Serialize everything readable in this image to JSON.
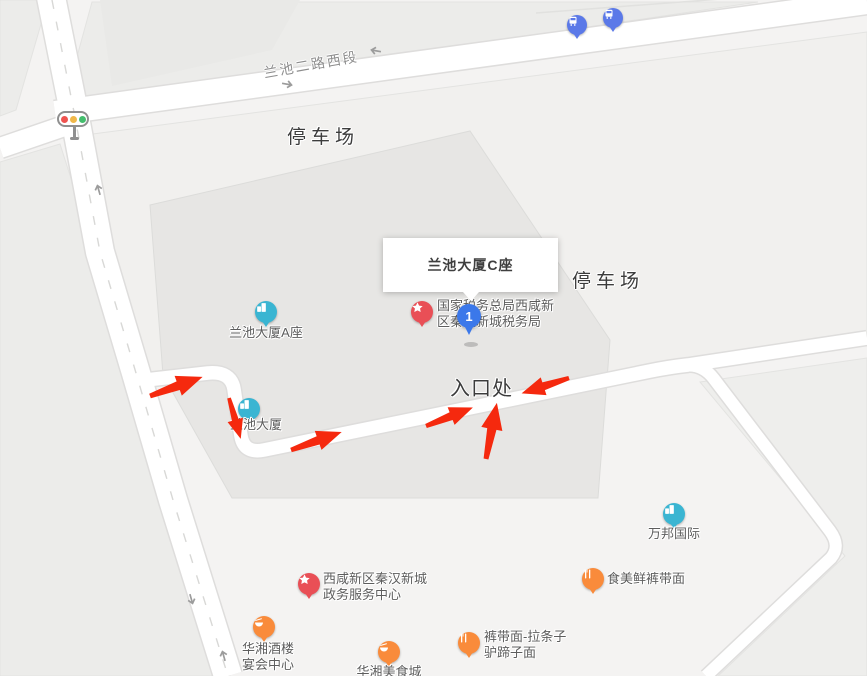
{
  "map": {
    "road_label": {
      "name": "road-label-lanchi-2nd-road",
      "text": "兰池二路西段",
      "x": 262,
      "y": 63,
      "angle": -10
    },
    "area_labels": [
      {
        "name": "parking-lot-label-top",
        "text": "停车场",
        "x": 287,
        "y": 122,
        "size": 19,
        "ls": 5
      },
      {
        "name": "parking-lot-label-right",
        "text": "停车场",
        "x": 572,
        "y": 266,
        "size": 19,
        "ls": 5
      },
      {
        "name": "entrance-label",
        "text": "入口处",
        "x": 450,
        "y": 372,
        "size": 20,
        "ls": 1
      }
    ],
    "infobox": {
      "title": "兰池大厦C座"
    },
    "selected_marker": {
      "label": "1"
    },
    "colors": {
      "poi_teal": "#3ab5d2",
      "poi_orange": "#f98b3b",
      "poi_red": "#e94f56",
      "bus_blue": "#5b79e8",
      "marker_blue": "#3b78ea",
      "route_arrow_red": "#f5290e",
      "road_white": "#ffffff",
      "building_gray": "#e7e6e4"
    },
    "pois": [
      {
        "name": "poi-lanchi-tower-a",
        "icon": "building-icon",
        "color": "#3ab5d2",
        "x": 266,
        "y": 312,
        "label": {
          "text": "兰池大厦A座",
          "x": 266,
          "y": 325,
          "align": "center"
        }
      },
      {
        "name": "poi-lanchi-tower",
        "icon": "building-icon",
        "color": "#3ab5d2",
        "x": 249,
        "y": 409,
        "label": {
          "text": "兰池大厦",
          "x": 256,
          "y": 417,
          "align": "center"
        }
      },
      {
        "name": "poi-wanbang-international",
        "icon": "building-icon",
        "color": "#3ab5d2",
        "x": 674,
        "y": 514,
        "label": {
          "text": "万邦国际",
          "x": 674,
          "y": 526,
          "align": "center"
        }
      },
      {
        "name": "poi-tax-bureau",
        "icon": "star-icon",
        "color": "#e94f56",
        "x": 422,
        "y": 312,
        "label": {
          "text": "国家税务总局西咸新\n区秦汉新城税务局",
          "x": 437,
          "y": 298,
          "align": "left"
        }
      },
      {
        "name": "poi-government-service-center",
        "icon": "star-icon",
        "color": "#e94f56",
        "x": 309,
        "y": 584,
        "label": {
          "text": "西咸新区秦汉新城\n政务服务中心",
          "x": 323,
          "y": 571,
          "align": "left"
        }
      },
      {
        "name": "poi-shimeixian-noodles",
        "icon": "restaurant-icon",
        "color": "#f98b3b",
        "x": 593,
        "y": 579,
        "label": {
          "text": "食美鲜裤带面",
          "x": 607,
          "y": 571,
          "align": "left"
        }
      },
      {
        "name": "poi-kudaimian-noodles",
        "icon": "restaurant-icon",
        "color": "#f98b3b",
        "x": 469,
        "y": 643,
        "label": {
          "text": "裤带面-拉条子\n驴蹄子面",
          "x": 484,
          "y": 629,
          "align": "left"
        }
      },
      {
        "name": "poi-huaxiang-banquet-hall",
        "icon": "dish-icon",
        "color": "#f98b3b",
        "x": 264,
        "y": 627,
        "label": {
          "text": "华湘酒楼\n宴会中心",
          "x": 268,
          "y": 641,
          "align": "center"
        }
      },
      {
        "name": "poi-huaxiang-food-city",
        "icon": "dish-icon",
        "color": "#f98b3b",
        "x": 389,
        "y": 652,
        "label": {
          "text": "华湘美食城",
          "x": 389,
          "y": 664,
          "align": "center"
        }
      }
    ],
    "bus_stops": [
      {
        "name": "bus-stop-pin-1",
        "icon": "bus-icon",
        "color": "#5b79e8",
        "x": 577,
        "y": 25
      },
      {
        "name": "bus-stop-pin-2",
        "icon": "bus-icon",
        "color": "#5b79e8",
        "x": 613,
        "y": 18
      }
    ]
  }
}
